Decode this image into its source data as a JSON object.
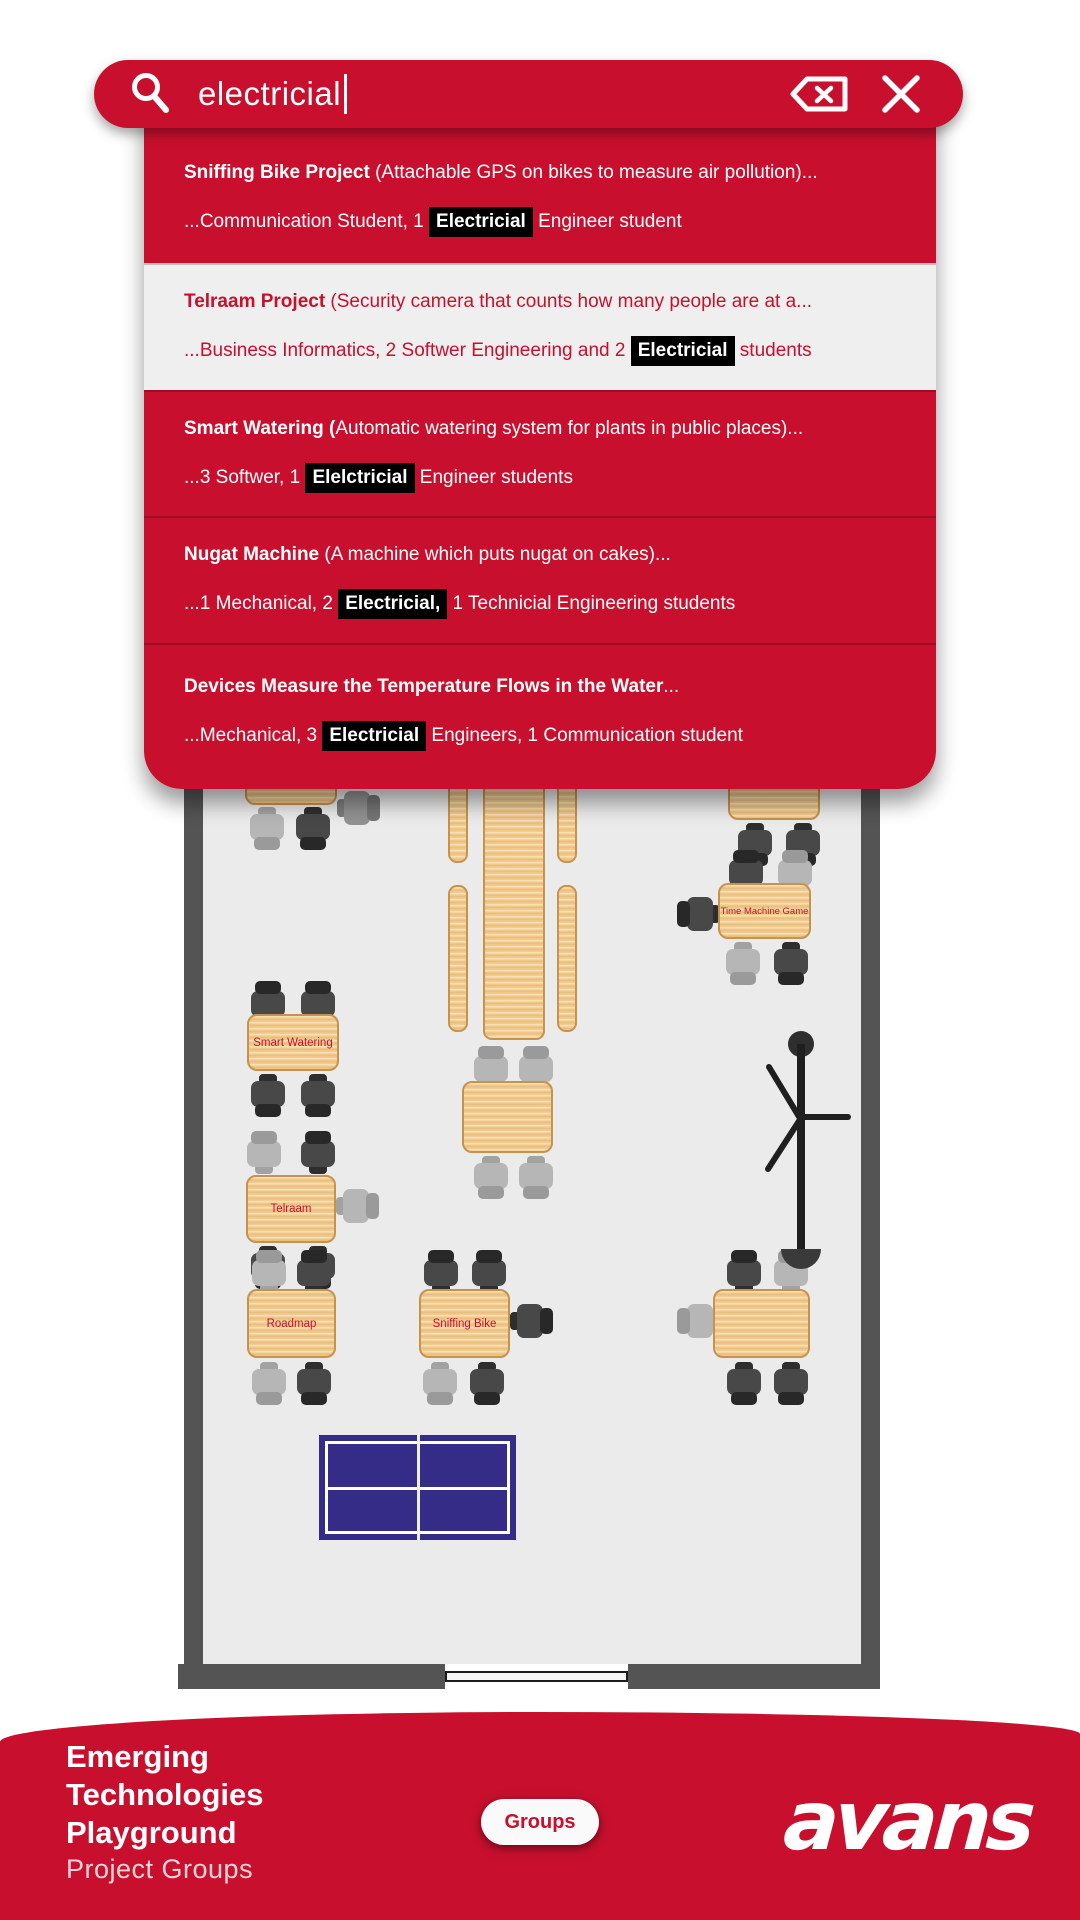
{
  "colors": {
    "brand_red": "#C8102E",
    "row_light_bg": "#efefef",
    "highlight_bg": "#000000",
    "highlight_text": "#ffffff",
    "floor": "#ebebeb",
    "wall": "#545454",
    "wood": "#f4cf94",
    "wood_border": "#c6934e",
    "pingpong_blue": "#352c87"
  },
  "search": {
    "value": "electricial",
    "icons": [
      "search-icon",
      "backspace-icon",
      "close-icon"
    ]
  },
  "results": [
    {
      "t_bold": "Sniffing Bike Project",
      "t_rest": " (Attachable GPS on bikes to measure air pollution)...",
      "s_pre": "...Communication Student, 1 ",
      "s_hl": "Electricial",
      "s_post": " Engineer student",
      "theme": "red"
    },
    {
      "t_bold": "Telraam Project",
      "t_rest": " (Security camera that counts how many people are at a...",
      "s_pre": "...Business Informatics, 2 Softwer Engineering and 2 ",
      "s_hl": "Electricial",
      "s_post": " students",
      "theme": "light"
    },
    {
      "t_bold": "Smart Watering (",
      "t_rest": "Automatic watering system for plants in public places)...",
      "s_pre": "...3 Softwer, 1 ",
      "s_hl": "Elelctricial",
      "s_post": " Engineer students",
      "theme": "red"
    },
    {
      "t_bold": "Nugat Machine",
      "t_rest": " (A machine which puts nugat on cakes)...",
      "s_pre": "...1 Mechanical, 2 ",
      "s_hl": "Electricial,",
      "s_post": " 1 Technicial Engineering students",
      "theme": "red"
    },
    {
      "t_bold": "Devices Measure the Temperature Flows in the Water",
      "t_rest": "...",
      "s_pre": "...Mechanical, 3 ",
      "s_hl": "Electricial",
      "s_post": " Engineers, 1 Communication student",
      "theme": "red"
    }
  ],
  "map": {
    "walls": [
      {
        "x": 184,
        "y": 760,
        "w": 19,
        "h": 904
      },
      {
        "x": 861,
        "y": 760,
        "w": 19,
        "h": 904
      },
      {
        "x": 178,
        "y": 1664,
        "w": 267,
        "h": 25
      },
      {
        "x": 628,
        "y": 1664,
        "w": 252,
        "h": 25
      }
    ],
    "floor": {
      "x": 203,
      "y": 760,
      "w": 658,
      "h": 904
    },
    "door": {
      "x": 445,
      "y": 1671,
      "w": 183,
      "h": 11
    },
    "tables": [
      {
        "id": "table-top-left",
        "x": 245,
        "y": 735,
        "w": 92,
        "h": 70,
        "label": ""
      },
      {
        "id": "table-top-right",
        "x": 728,
        "y": 735,
        "w": 92,
        "h": 85,
        "label": ""
      },
      {
        "id": "table-time-machine-game",
        "x": 718,
        "y": 883,
        "w": 93,
        "h": 56,
        "label": "Time Machine Game",
        "small": true
      },
      {
        "id": "table-smart-watering",
        "x": 247,
        "y": 1014,
        "w": 92,
        "h": 57,
        "label": "Smart Watering"
      },
      {
        "id": "table-center",
        "x": 462,
        "y": 1081,
        "w": 91,
        "h": 72,
        "label": ""
      },
      {
        "id": "table-telraam",
        "x": 246,
        "y": 1175,
        "w": 90,
        "h": 68,
        "label": "Telraam"
      },
      {
        "id": "table-roadmap",
        "x": 247,
        "y": 1289,
        "w": 89,
        "h": 69,
        "label": "Roadmap"
      },
      {
        "id": "table-sniffing-bike",
        "x": 419,
        "y": 1289,
        "w": 91,
        "h": 69,
        "label": "Sniffing Bike"
      },
      {
        "id": "table-right-unlabeled",
        "x": 713,
        "y": 1289,
        "w": 97,
        "h": 69,
        "label": ""
      }
    ],
    "benches": [
      {
        "x": 448,
        "y": 770,
        "w": 20,
        "h": 93
      },
      {
        "x": 448,
        "y": 885,
        "w": 20,
        "h": 147
      },
      {
        "x": 483,
        "y": 740,
        "w": 62,
        "h": 300
      },
      {
        "x": 557,
        "y": 770,
        "w": 20,
        "h": 93
      },
      {
        "x": 557,
        "y": 885,
        "w": 20,
        "h": 147
      }
    ],
    "chairs": [
      {
        "x": 250,
        "y": 806,
        "r": 180,
        "s": "light"
      },
      {
        "x": 296,
        "y": 806,
        "r": 180,
        "s": "dark"
      },
      {
        "x": 341,
        "y": 786,
        "r": 90,
        "s": "mid"
      },
      {
        "x": 738,
        "y": 822,
        "r": 180,
        "s": "dark"
      },
      {
        "x": 786,
        "y": 822,
        "r": 180,
        "s": "dark"
      },
      {
        "x": 729,
        "y": 850,
        "r": 0,
        "s": "dark"
      },
      {
        "x": 778,
        "y": 850,
        "r": 0,
        "s": "light"
      },
      {
        "x": 682,
        "y": 892,
        "r": 270,
        "s": "dark"
      },
      {
        "x": 726,
        "y": 941,
        "r": 180,
        "s": "light"
      },
      {
        "x": 774,
        "y": 941,
        "r": 180,
        "s": "dark"
      },
      {
        "x": 251,
        "y": 981,
        "r": 0,
        "s": "dark"
      },
      {
        "x": 301,
        "y": 981,
        "r": 0,
        "s": "dark"
      },
      {
        "x": 251,
        "y": 1073,
        "r": 180,
        "s": "dark"
      },
      {
        "x": 301,
        "y": 1073,
        "r": 180,
        "s": "dark"
      },
      {
        "x": 474,
        "y": 1046,
        "r": 0,
        "s": "light"
      },
      {
        "x": 519,
        "y": 1046,
        "r": 0,
        "s": "light"
      },
      {
        "x": 474,
        "y": 1155,
        "r": 180,
        "s": "light"
      },
      {
        "x": 519,
        "y": 1155,
        "r": 180,
        "s": "light"
      },
      {
        "x": 247,
        "y": 1131,
        "r": 0,
        "s": "light"
      },
      {
        "x": 301,
        "y": 1131,
        "r": 0,
        "s": "dark"
      },
      {
        "x": 340,
        "y": 1184,
        "r": 90,
        "s": "light"
      },
      {
        "x": 251,
        "y": 1245,
        "r": 180,
        "s": "dark"
      },
      {
        "x": 301,
        "y": 1245,
        "r": 180,
        "s": "dark"
      },
      {
        "x": 252,
        "y": 1250,
        "r": 0,
        "s": "light"
      },
      {
        "x": 297,
        "y": 1250,
        "r": 0,
        "s": "dark"
      },
      {
        "x": 252,
        "y": 1361,
        "r": 180,
        "s": "light"
      },
      {
        "x": 297,
        "y": 1361,
        "r": 180,
        "s": "dark"
      },
      {
        "x": 424,
        "y": 1250,
        "r": 0,
        "s": "dark"
      },
      {
        "x": 472,
        "y": 1250,
        "r": 0,
        "s": "dark"
      },
      {
        "x": 514,
        "y": 1299,
        "r": 90,
        "s": "dark"
      },
      {
        "x": 423,
        "y": 1361,
        "r": 180,
        "s": "light"
      },
      {
        "x": 470,
        "y": 1361,
        "r": 180,
        "s": "dark"
      },
      {
        "x": 727,
        "y": 1250,
        "r": 0,
        "s": "dark"
      },
      {
        "x": 774,
        "y": 1250,
        "r": 0,
        "s": "light"
      },
      {
        "x": 682,
        "y": 1299,
        "r": 270,
        "s": "light"
      },
      {
        "x": 727,
        "y": 1361,
        "r": 180,
        "s": "dark"
      },
      {
        "x": 774,
        "y": 1361,
        "r": 180,
        "s": "dark"
      }
    ],
    "pingpong_table": {
      "x": 319,
      "y": 1435,
      "w": 197,
      "h": 105
    },
    "coat_rack": {
      "x": 748,
      "y": 1028
    }
  },
  "footer": {
    "title_lines": [
      "Emerging",
      "Technologies",
      "Playground"
    ],
    "subtitle": "Project Groups",
    "groups_label": "Groups",
    "brand": "avans"
  }
}
